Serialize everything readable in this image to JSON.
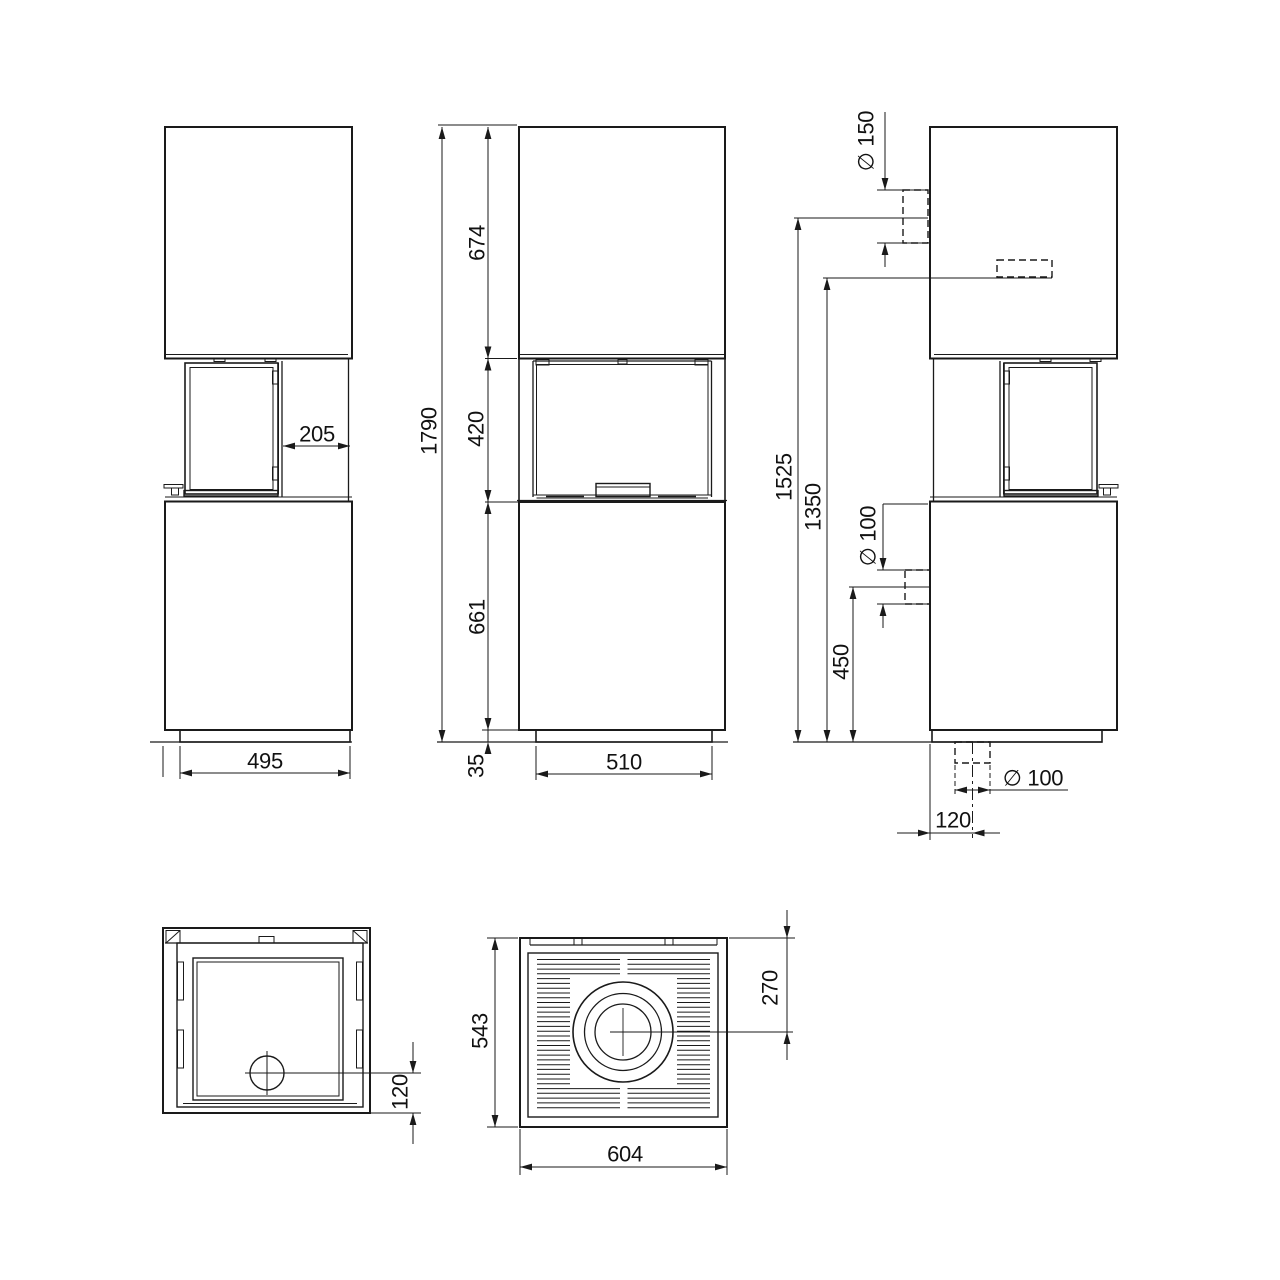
{
  "drawing": {
    "background_color": "#ffffff",
    "line_color": "#1a1a1a",
    "dims": {
      "side": {
        "recess_depth": "205",
        "base_depth": "495"
      },
      "front": {
        "top_module": "674",
        "firebox": "420",
        "bottom_module": "661",
        "total_height": "1790",
        "base_height": "35",
        "base_width": "510"
      },
      "back": {
        "flue_diameter": "∅ 150",
        "flue_height": "1525",
        "rear_outlet_height": "1350",
        "air_inlet_diameter": "∅ 100",
        "air_inlet_height": "450",
        "floor_pipe_diameter": "∅ 100",
        "floor_pipe_offset": "120"
      },
      "door": {
        "damper_offset": "120"
      },
      "top": {
        "depth": "543",
        "flue_center_offset": "270",
        "width": "604"
      }
    }
  }
}
